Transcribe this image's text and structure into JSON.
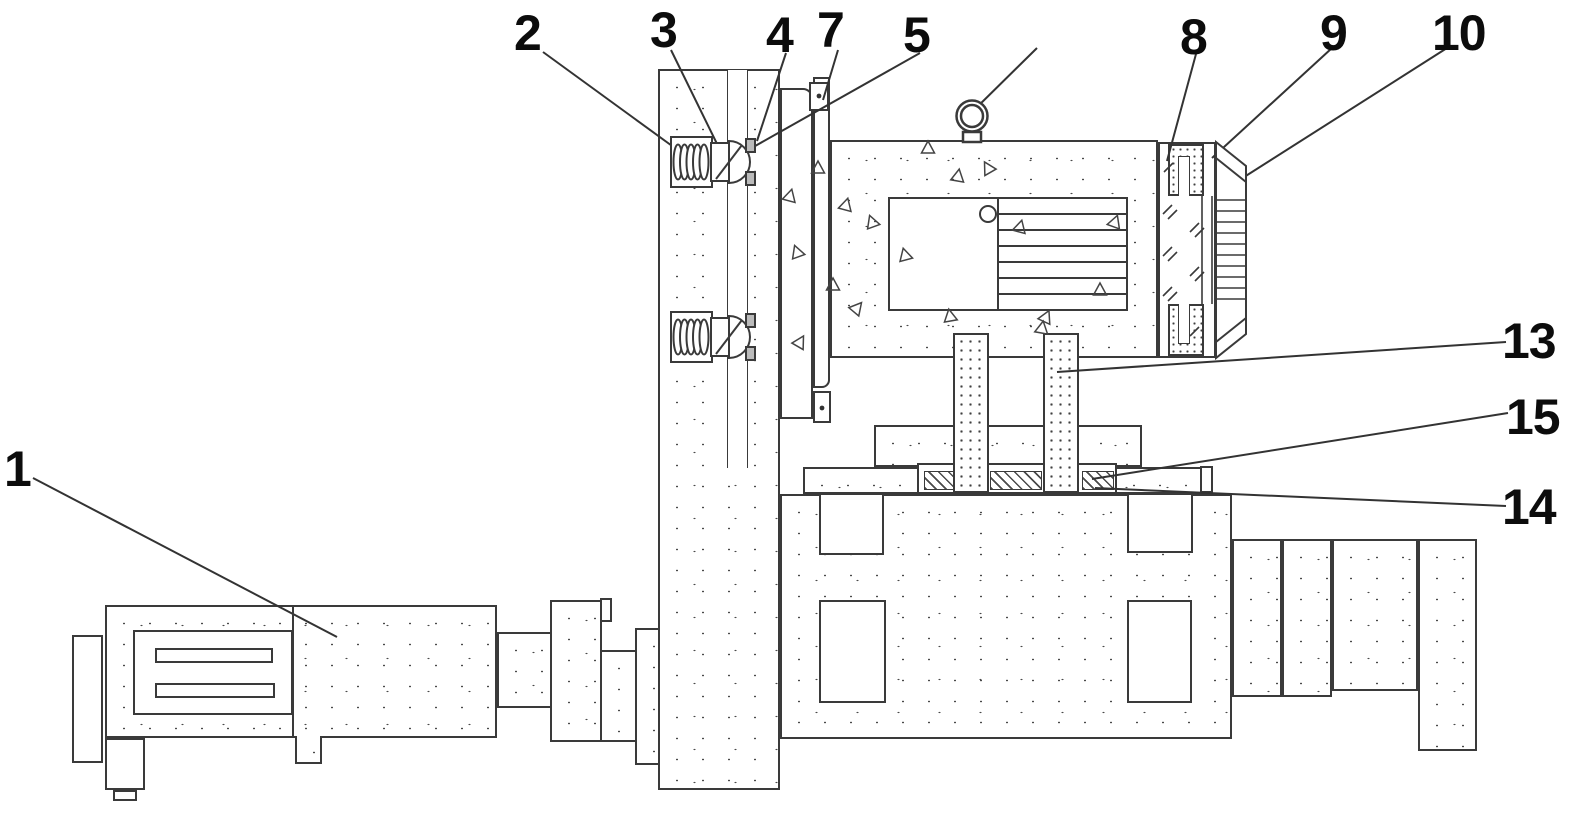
{
  "figure": {
    "kind": "patent-style technical line drawing",
    "background_color": "#ffffff",
    "line_color": "#3a3a3a",
    "label_color": "#0c0c0c"
  },
  "callouts": [
    {
      "text": "1"
    },
    {
      "text": "2"
    },
    {
      "text": "3"
    },
    {
      "text": "4"
    },
    {
      "text": "7"
    },
    {
      "text": "5"
    },
    {
      "text": "8"
    },
    {
      "text": "9"
    },
    {
      "text": "10"
    },
    {
      "text": "13"
    },
    {
      "text": "15"
    },
    {
      "text": "14"
    }
  ]
}
